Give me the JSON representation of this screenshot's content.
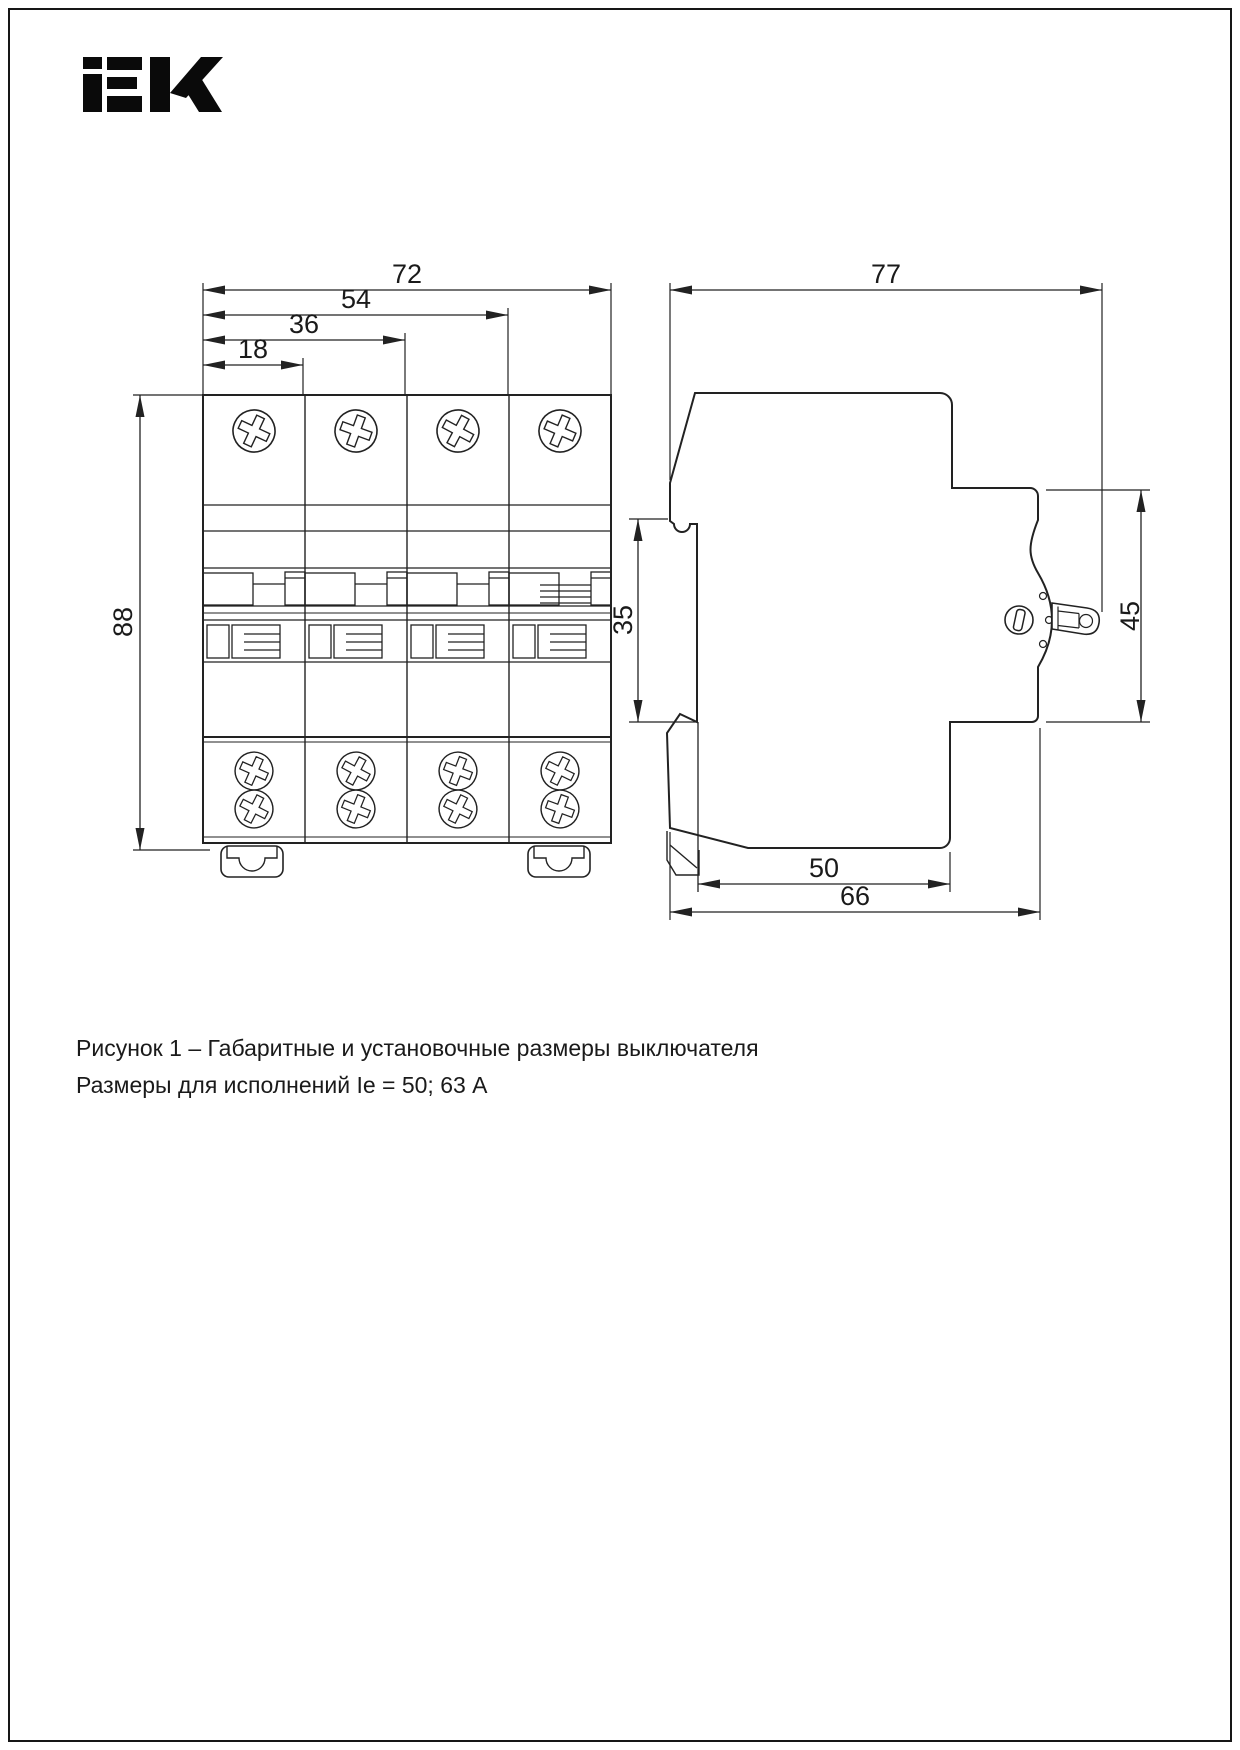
{
  "page": {
    "background": "#ffffff",
    "frame_color": "#161616",
    "line_color": "#222222"
  },
  "logo": {
    "text": "IEK"
  },
  "figure": {
    "description": "Gabarit and mounting dimensions of a 4-pole modular circuit breaker, front view and side view",
    "front_view": {
      "dim_72": "72",
      "dim_54": "54",
      "dim_36": "36",
      "dim_18": "18",
      "dim_88": "88"
    },
    "side_view": {
      "dim_77": "77",
      "dim_35": "35",
      "dim_45": "45",
      "dim_50": "50",
      "dim_66": "66"
    }
  },
  "caption": {
    "line1": "Рисунок 1 – Габаритные и установочные размеры выключателя",
    "line2": "Размеры для исполнений Ie = 50; 63 А"
  }
}
